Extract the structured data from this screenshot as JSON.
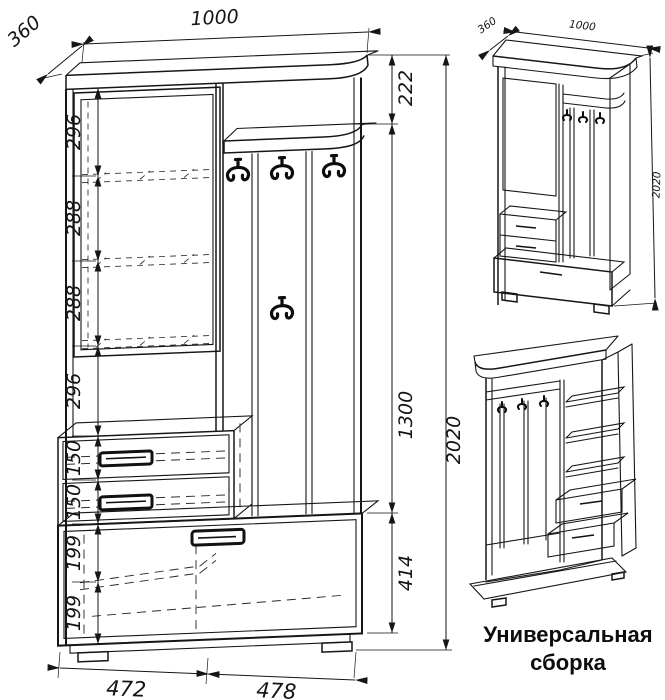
{
  "colors": {
    "line": "#161616",
    "background": "#ffffff"
  },
  "caption": {
    "line1": "Универсальная",
    "line2": "сборка"
  },
  "main_view": {
    "top_width": "1000",
    "depth": "360",
    "left_chain": [
      "296",
      "288",
      "288",
      "296",
      "150",
      "150",
      "199",
      "199"
    ],
    "right_chain": [
      "222",
      "1300",
      "414"
    ],
    "total_height": "2020",
    "bottom_widths": [
      "472",
      "478"
    ]
  },
  "assembled_view": {
    "depth": "360",
    "width": "1000",
    "height": "2020"
  }
}
